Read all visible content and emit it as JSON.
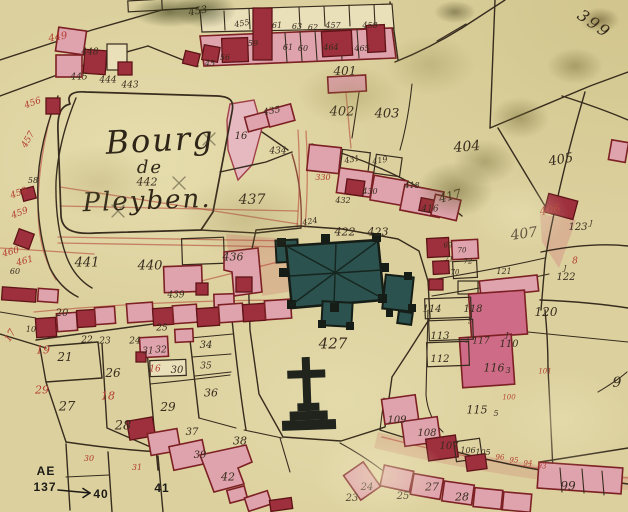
{
  "map": {
    "kind": "historical-cadastral-map",
    "colors": {
      "parchment": "#dcd19e",
      "parchment_light": "#e9e0ba",
      "ink": "#372c1e",
      "red_ink": "#b23b31",
      "building_pink": "#dfa3ad",
      "building_dark_red": "#9e2f3c",
      "building_magenta": "#ce6b87",
      "building_outline": "#7c2024",
      "church_teal": "#2b524e",
      "church_outline": "#161d16",
      "pencil": "#8f8868"
    },
    "labels": [
      {
        "t": "Bourg",
        "x": 160,
        "y": 140,
        "s": 32,
        "c": "script",
        "r": -3,
        "name": "title-bourg"
      },
      {
        "t": "de",
        "x": 150,
        "y": 168,
        "s": 18,
        "c": "script",
        "name": "title-de"
      },
      {
        "t": "442",
        "x": 147,
        "y": 182,
        "s": 11,
        "name": "parcel-442"
      },
      {
        "t": "Pleyben.",
        "x": 147,
        "y": 201,
        "s": 26,
        "c": "script",
        "r": -2,
        "name": "title-pleyben"
      },
      {
        "t": "399",
        "x": 594,
        "y": 24,
        "s": 16,
        "c": "script",
        "r": 35,
        "name": "sheet-number"
      },
      {
        "t": "427",
        "x": 333,
        "y": 344,
        "s": 15,
        "name": "parcel-427-churchyard"
      },
      {
        "t": "437",
        "x": 252,
        "y": 200,
        "s": 14
      },
      {
        "t": "407",
        "x": 524,
        "y": 234,
        "s": 14,
        "r": -8
      },
      {
        "t": "404",
        "x": 467,
        "y": 147,
        "s": 14,
        "r": -5
      },
      {
        "t": "403",
        "x": 387,
        "y": 114,
        "s": 13
      },
      {
        "t": "402",
        "x": 342,
        "y": 112,
        "s": 13
      },
      {
        "t": "405",
        "x": 561,
        "y": 160,
        "s": 13,
        "r": -10
      },
      {
        "t": "401",
        "x": 345,
        "y": 71,
        "s": 12
      },
      {
        "t": "441",
        "x": 87,
        "y": 263,
        "s": 13
      },
      {
        "t": "440",
        "x": 150,
        "y": 266,
        "s": 13
      },
      {
        "t": "436",
        "x": 233,
        "y": 257,
        "s": 11
      },
      {
        "t": "439",
        "x": 176,
        "y": 296,
        "s": 9
      },
      {
        "t": "435",
        "x": 272,
        "y": 112,
        "s": 9,
        "r": -10
      },
      {
        "t": "434",
        "x": 278,
        "y": 152,
        "s": 9
      },
      {
        "t": "16",
        "x": 241,
        "y": 137,
        "s": 10
      },
      {
        "t": "422",
        "x": 345,
        "y": 232,
        "s": 11
      },
      {
        "t": "423",
        "x": 378,
        "y": 232,
        "s": 11
      },
      {
        "t": "424",
        "x": 310,
        "y": 222,
        "s": 8,
        "r": -10
      },
      {
        "t": "432",
        "x": 343,
        "y": 201,
        "s": 8
      },
      {
        "t": "431",
        "x": 352,
        "y": 160,
        "s": 8,
        "r": -10
      },
      {
        "t": "419",
        "x": 380,
        "y": 161,
        "s": 8,
        "r": -10
      },
      {
        "t": "418",
        "x": 412,
        "y": 186,
        "s": 8
      },
      {
        "t": "430",
        "x": 370,
        "y": 192,
        "s": 8
      },
      {
        "t": "416",
        "x": 430,
        "y": 210,
        "s": 9
      },
      {
        "t": "417",
        "x": 450,
        "y": 196,
        "s": 12,
        "r": -15
      },
      {
        "t": "406",
        "x": 550,
        "y": 210,
        "s": 11,
        "c": "red",
        "r": -10
      },
      {
        "t": "123",
        "x": 578,
        "y": 228,
        "s": 10
      },
      {
        "t": "J",
        "x": 591,
        "y": 224,
        "s": 7
      },
      {
        "t": "J",
        "x": 565,
        "y": 269,
        "s": 7
      },
      {
        "t": "122",
        "x": 566,
        "y": 278,
        "s": 10
      },
      {
        "t": "121",
        "x": 504,
        "y": 272,
        "s": 8
      },
      {
        "t": "8",
        "x": 575,
        "y": 262,
        "s": 9,
        "c": "red"
      },
      {
        "t": "120",
        "x": 546,
        "y": 312,
        "s": 12
      },
      {
        "t": "114",
        "x": 432,
        "y": 310,
        "s": 10
      },
      {
        "t": "118",
        "x": 473,
        "y": 310,
        "s": 10
      },
      {
        "t": "5",
        "x": 470,
        "y": 322,
        "s": 7
      },
      {
        "t": "113",
        "x": 440,
        "y": 337,
        "s": 10
      },
      {
        "t": "112",
        "x": 440,
        "y": 360,
        "s": 10
      },
      {
        "t": "3",
        "x": 467,
        "y": 341,
        "s": 7
      },
      {
        "t": "117",
        "x": 481,
        "y": 342,
        "s": 9
      },
      {
        "t": "J",
        "x": 507,
        "y": 336,
        "s": 7
      },
      {
        "t": "110",
        "x": 509,
        "y": 345,
        "s": 10
      },
      {
        "t": "116",
        "x": 494,
        "y": 368,
        "s": 11
      },
      {
        "t": "3",
        "x": 508,
        "y": 371,
        "s": 8
      },
      {
        "t": "101",
        "x": 545,
        "y": 372,
        "s": 7,
        "c": "red"
      },
      {
        "t": "100",
        "x": 509,
        "y": 398,
        "s": 7,
        "c": "red"
      },
      {
        "t": "115",
        "x": 477,
        "y": 410,
        "s": 11
      },
      {
        "t": "5",
        "x": 496,
        "y": 414,
        "s": 8
      },
      {
        "t": "109",
        "x": 397,
        "y": 421,
        "s": 10
      },
      {
        "t": "108",
        "x": 427,
        "y": 434,
        "s": 10
      },
      {
        "t": "107",
        "x": 449,
        "y": 447,
        "s": 10
      },
      {
        "t": "106",
        "x": 468,
        "y": 451,
        "s": 8
      },
      {
        "t": "105",
        "x": 483,
        "y": 453,
        "s": 8
      },
      {
        "t": "96",
        "x": 500,
        "y": 458,
        "s": 7,
        "c": "red"
      },
      {
        "t": "95",
        "x": 514,
        "y": 461,
        "s": 7,
        "c": "red"
      },
      {
        "t": "94",
        "x": 528,
        "y": 464,
        "s": 7,
        "c": "red"
      },
      {
        "t": "93",
        "x": 542,
        "y": 467,
        "s": 7,
        "c": "red"
      },
      {
        "t": "99",
        "x": 568,
        "y": 486,
        "s": 12
      },
      {
        "t": "9",
        "x": 617,
        "y": 383,
        "s": 14
      },
      {
        "t": "23",
        "x": 352,
        "y": 499,
        "s": 10
      },
      {
        "t": "24",
        "x": 367,
        "y": 488,
        "s": 10
      },
      {
        "t": "25",
        "x": 403,
        "y": 497,
        "s": 10
      },
      {
        "t": "27",
        "x": 432,
        "y": 487,
        "s": 11
      },
      {
        "t": "28",
        "x": 462,
        "y": 497,
        "s": 11
      },
      {
        "t": "AE",
        "x": 46,
        "y": 471,
        "s": 12,
        "c": "modern",
        "name": "ref-code-ae"
      },
      {
        "t": "137",
        "x": 45,
        "y": 487,
        "s": 12,
        "c": "modern",
        "name": "ref-number-137"
      },
      {
        "t": "40",
        "x": 101,
        "y": 494,
        "s": 12,
        "c": "modern"
      },
      {
        "t": "41",
        "x": 162,
        "y": 488,
        "s": 12,
        "c": "modern"
      },
      {
        "t": "42",
        "x": 228,
        "y": 477,
        "s": 11
      },
      {
        "t": "38",
        "x": 240,
        "y": 441,
        "s": 11
      },
      {
        "t": "39",
        "x": 200,
        "y": 456,
        "s": 10
      },
      {
        "t": "37",
        "x": 192,
        "y": 433,
        "s": 10
      },
      {
        "t": "30",
        "x": 89,
        "y": 459,
        "s": 8,
        "c": "red"
      },
      {
        "t": "31",
        "x": 137,
        "y": 468,
        "s": 8,
        "c": "red"
      },
      {
        "t": "20",
        "x": 62,
        "y": 314,
        "s": 10
      },
      {
        "t": "10",
        "x": 31,
        "y": 330,
        "s": 8
      },
      {
        "t": "19",
        "x": 43,
        "y": 350,
        "s": 11,
        "c": "red"
      },
      {
        "t": "17",
        "x": 11,
        "y": 336,
        "s": 10,
        "c": "red",
        "r": -60
      },
      {
        "t": "21",
        "x": 65,
        "y": 357,
        "s": 12
      },
      {
        "t": "22",
        "x": 87,
        "y": 341,
        "s": 9
      },
      {
        "t": "23",
        "x": 105,
        "y": 342,
        "s": 9
      },
      {
        "t": "24",
        "x": 135,
        "y": 342,
        "s": 9
      },
      {
        "t": "25",
        "x": 162,
        "y": 329,
        "s": 9
      },
      {
        "t": "26",
        "x": 113,
        "y": 373,
        "s": 12
      },
      {
        "t": "29",
        "x": 42,
        "y": 390,
        "s": 11,
        "c": "red"
      },
      {
        "t": "27",
        "x": 67,
        "y": 407,
        "s": 13
      },
      {
        "t": "18",
        "x": 108,
        "y": 396,
        "s": 11,
        "c": "red"
      },
      {
        "t": "28",
        "x": 123,
        "y": 426,
        "s": 13
      },
      {
        "t": "29",
        "x": 168,
        "y": 407,
        "s": 12
      },
      {
        "t": "30",
        "x": 177,
        "y": 371,
        "s": 10
      },
      {
        "t": "16",
        "x": 155,
        "y": 370,
        "s": 9,
        "c": "red"
      },
      {
        "t": "31",
        "x": 148,
        "y": 352,
        "s": 9
      },
      {
        "t": "32",
        "x": 161,
        "y": 351,
        "s": 9
      },
      {
        "t": "34",
        "x": 206,
        "y": 346,
        "s": 10
      },
      {
        "t": "35",
        "x": 206,
        "y": 367,
        "s": 9
      },
      {
        "t": "36",
        "x": 211,
        "y": 393,
        "s": 11
      },
      {
        "t": "456",
        "x": 33,
        "y": 104,
        "s": 9,
        "c": "red",
        "r": -20
      },
      {
        "t": "457",
        "x": 29,
        "y": 140,
        "s": 9,
        "c": "red",
        "r": -60
      },
      {
        "t": "458",
        "x": 19,
        "y": 194,
        "s": 9,
        "c": "red",
        "r": -20
      },
      {
        "t": "459",
        "x": 20,
        "y": 214,
        "s": 9,
        "c": "red",
        "r": -20
      },
      {
        "t": "460",
        "x": 11,
        "y": 253,
        "s": 9,
        "c": "red",
        "r": -15
      },
      {
        "t": "461",
        "x": 25,
        "y": 262,
        "s": 9,
        "c": "red",
        "r": -15
      },
      {
        "t": "449",
        "x": 58,
        "y": 38,
        "s": 10,
        "c": "red",
        "r": -10
      },
      {
        "t": "448",
        "x": 90,
        "y": 53,
        "s": 9
      },
      {
        "t": "445",
        "x": 79,
        "y": 78,
        "s": 9
      },
      {
        "t": "444",
        "x": 108,
        "y": 81,
        "s": 9
      },
      {
        "t": "443",
        "x": 130,
        "y": 86,
        "s": 9
      },
      {
        "t": "453",
        "x": 198,
        "y": 12,
        "s": 10,
        "r": -10
      },
      {
        "t": "455",
        "x": 242,
        "y": 24,
        "s": 8,
        "r": -10
      },
      {
        "t": "61",
        "x": 277,
        "y": 26,
        "s": 8
      },
      {
        "t": "63",
        "x": 297,
        "y": 27,
        "s": 8
      },
      {
        "t": "62",
        "x": 313,
        "y": 28,
        "s": 8
      },
      {
        "t": "457",
        "x": 333,
        "y": 26,
        "s": 8
      },
      {
        "t": "458",
        "x": 370,
        "y": 26,
        "s": 8
      },
      {
        "t": "59",
        "x": 253,
        "y": 44,
        "s": 8
      },
      {
        "t": "61",
        "x": 288,
        "y": 48,
        "s": 8
      },
      {
        "t": "60",
        "x": 303,
        "y": 49,
        "s": 8
      },
      {
        "t": "464",
        "x": 331,
        "y": 48,
        "s": 8
      },
      {
        "t": "465",
        "x": 362,
        "y": 49,
        "s": 8
      },
      {
        "t": "56",
        "x": 225,
        "y": 58,
        "s": 8
      },
      {
        "t": "45",
        "x": 210,
        "y": 64,
        "s": 8
      },
      {
        "t": "58",
        "x": 33,
        "y": 181,
        "s": 8
      },
      {
        "t": "60",
        "x": 15,
        "y": 272,
        "s": 8
      },
      {
        "t": "330",
        "x": 323,
        "y": 178,
        "s": 8,
        "c": "red"
      },
      {
        "t": "69",
        "x": 448,
        "y": 246,
        "s": 7
      },
      {
        "t": "70",
        "x": 462,
        "y": 251,
        "s": 7
      },
      {
        "t": "71",
        "x": 449,
        "y": 260,
        "s": 7
      },
      {
        "t": "72",
        "x": 468,
        "y": 262,
        "s": 7
      },
      {
        "t": "70",
        "x": 455,
        "y": 273,
        "s": 7
      }
    ]
  }
}
